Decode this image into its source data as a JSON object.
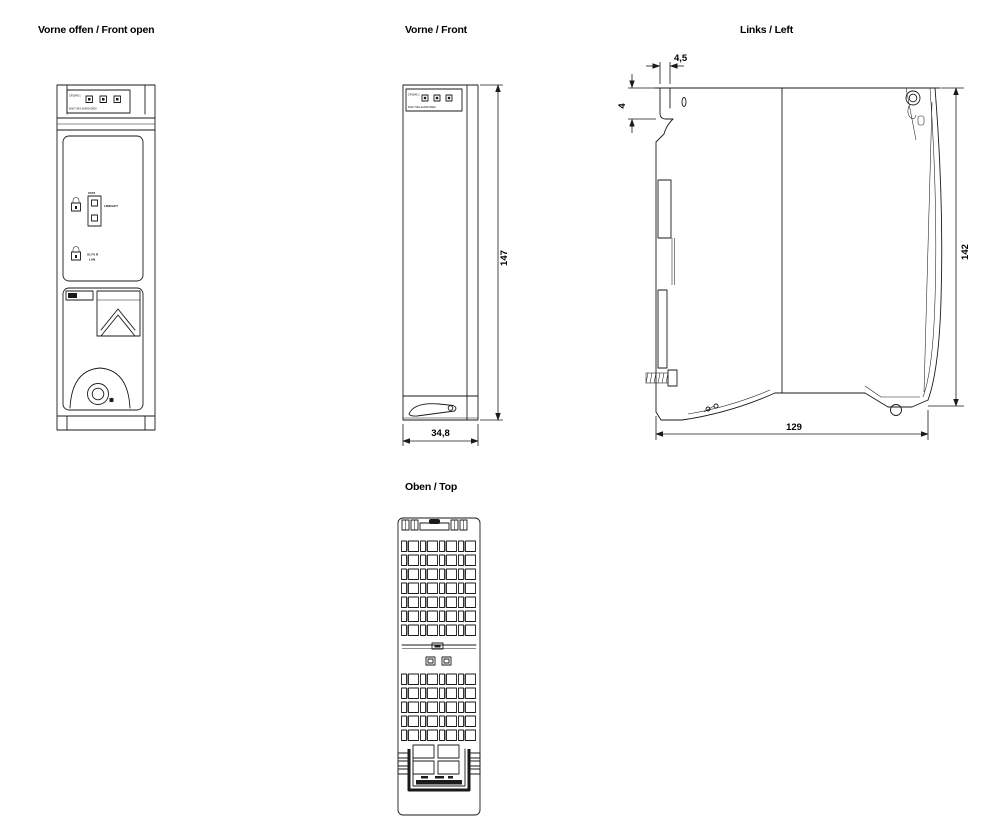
{
  "page": {
    "background": "#ffffff",
    "line_color": "#1a1a1a"
  },
  "views": {
    "front_open": {
      "title": "Vorne offen / Front open"
    },
    "front": {
      "title": "Vorne / Front",
      "dim_height": "147",
      "dim_width": "34,8"
    },
    "left": {
      "title": "Links / Left",
      "dim_hook_width": "4,5",
      "dim_hook_depth": "4",
      "dim_height": "142",
      "dim_depth": "129"
    },
    "top": {
      "title": "Oben / Top"
    }
  },
  "module": {
    "type_label": "CP1543-1",
    "order_number": "6GK7 543-1AX00-0XE0",
    "port_label": "X1P1",
    "port_led_label": "LINK/ACT",
    "port_name": "X1 P1 R",
    "port_sub": "LAN"
  }
}
